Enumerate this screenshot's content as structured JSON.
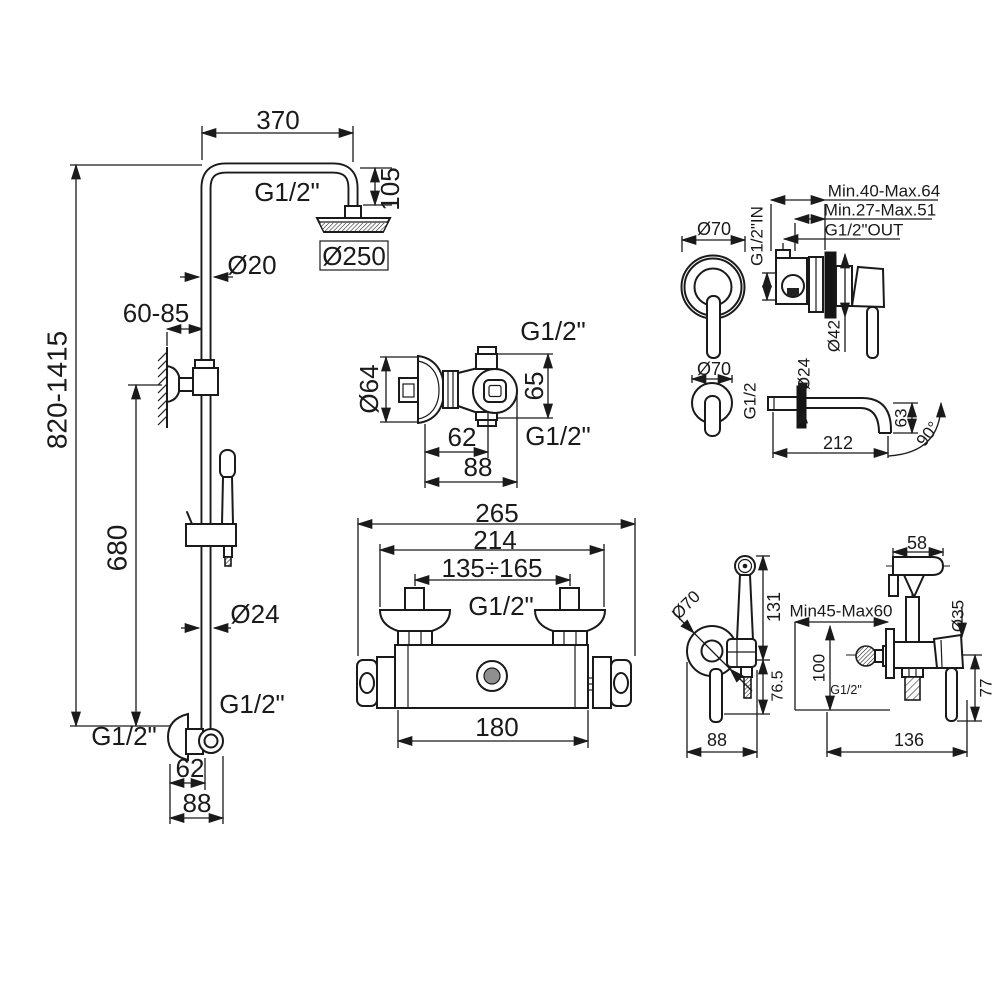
{
  "components": {
    "shower_column": {
      "labels": {
        "arm_width": "370",
        "thread_top": "G1/2\"",
        "head_offset": "105",
        "head_diameter": "Ø250",
        "pipe_diameter": "Ø20",
        "bracket_range": "60-85",
        "total_height": "820-1415",
        "lower_height": "680",
        "rail_diameter": "Ø24",
        "hose_thread": "G1/2\"",
        "inlet_thread": "G1/2\"",
        "elbow_depth": "62",
        "elbow_overall": "88"
      }
    },
    "shower_valve": {
      "labels": {
        "thread_top": "G1/2\"",
        "flange_diameter": "Ø64",
        "port_offset": "65",
        "depth": "62",
        "thread_bottom": "G1/2\"",
        "overall_depth": "88"
      }
    },
    "thermostatic_mixer": {
      "labels": {
        "overall_width": "265",
        "union_width": "214",
        "center_distance": "135÷165",
        "thread": "G1/2\"",
        "body_width": "180"
      }
    },
    "concealed_mixer": {
      "labels": {
        "depth_range_outer": "Min.40-Max.64",
        "depth_range_inner": "Min.27-Max.51",
        "outlet_thread": "G1/2\"OUT",
        "inlet_thread": "G1/2\"IN",
        "escutcheon_diameter": "Ø70",
        "plate_diameter": "Ø42"
      }
    },
    "wall_spout": {
      "labels": {
        "escutcheon_diameter": "Ø70",
        "thread": "G1/2",
        "tube_diameter": "Ø24",
        "drop": "63",
        "length": "212",
        "angle": "90°"
      }
    },
    "bidet_shower": {
      "labels": {
        "head_width": "58",
        "height_upper": "131",
        "escutcheon_diameter": "Ø70",
        "height_lower": "76.5",
        "width_left": "88",
        "depth_range": "Min45-Max60",
        "height": "100",
        "thread": "G1/2\"",
        "holder_diameter": "Ø35",
        "handle_drop": "77",
        "width_right": "136"
      }
    }
  }
}
